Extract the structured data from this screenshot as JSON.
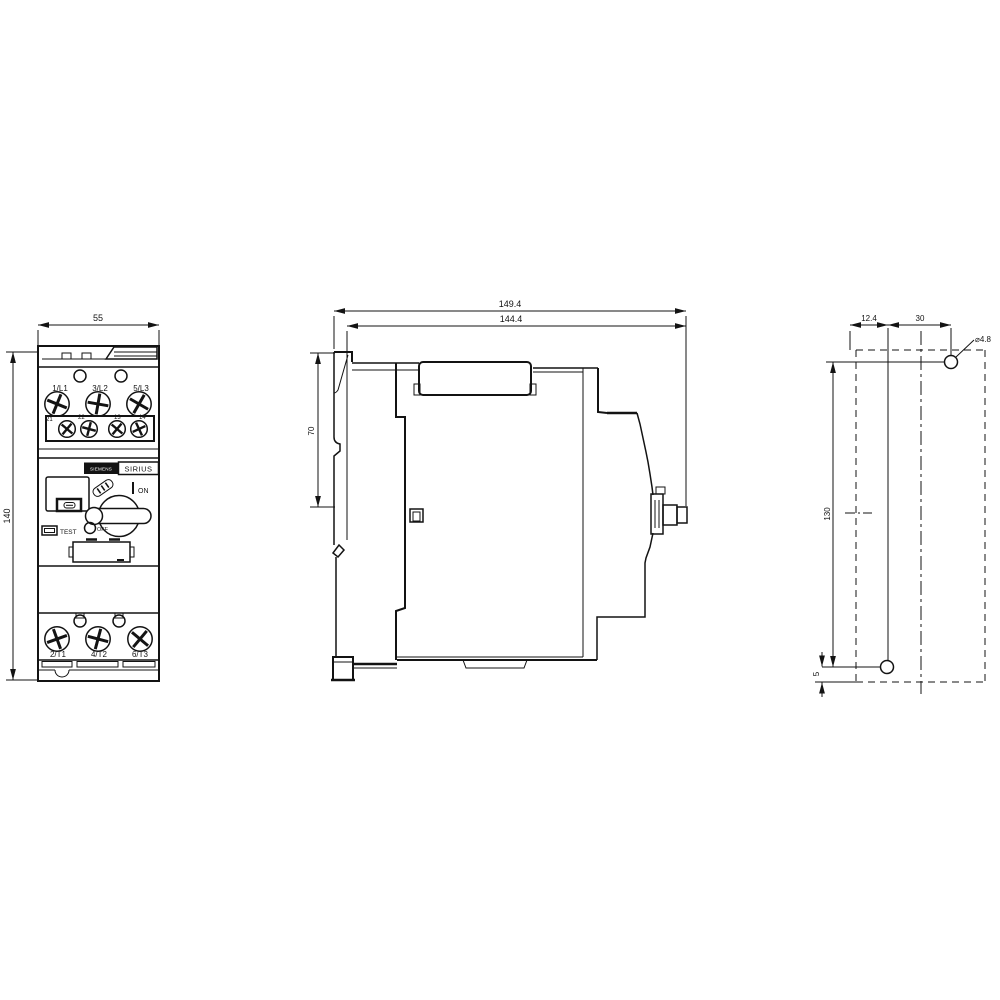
{
  "front_view": {
    "width_dim": "55",
    "height_dim": "140",
    "line_terminals": [
      "1/L1",
      "3/L2",
      "5/L3"
    ],
    "aux_terminals": [
      "21",
      "22",
      "13",
      "14"
    ],
    "load_terminals": [
      "2/T1",
      "4/T2",
      "6/T3"
    ],
    "brand": "SIEMENS",
    "family": "SIRIUS",
    "on_label": "ON",
    "off_label": "OFF",
    "test_label": "TEST"
  },
  "side_view": {
    "overall_width_dim": "149.4",
    "body_width_dim": "144.4",
    "din_clip_dim": "70"
  },
  "drill_plan": {
    "hole_offset_x_dim": "12.4",
    "hole_spacing_x_dim": "30",
    "hole_spacing_y_dim": "130",
    "bottom_offset_dim": "5",
    "hole_diameter": "⌀4.8"
  }
}
